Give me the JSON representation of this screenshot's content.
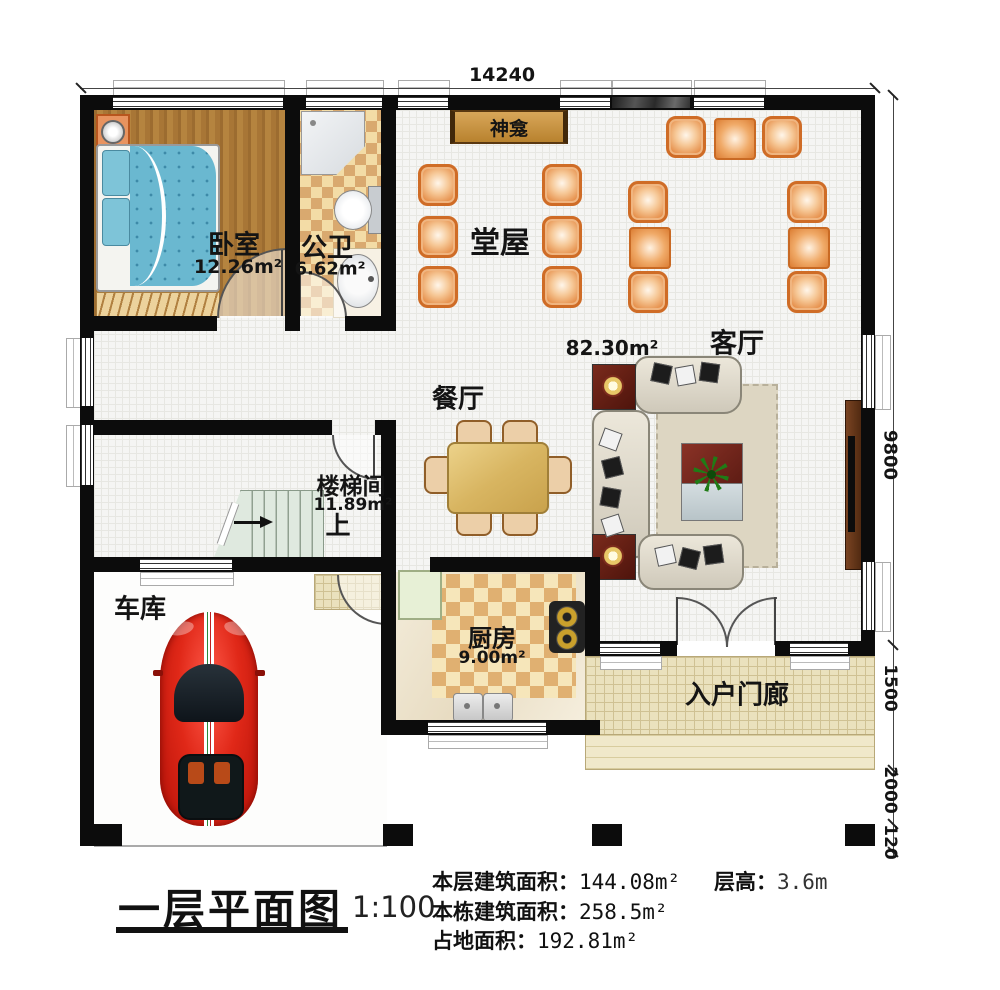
{
  "title": {
    "name": "一层平面图",
    "scale": "1:100"
  },
  "stats": {
    "floor_area_label": "本层建筑面积：",
    "floor_area_value": "144.08m²",
    "height_label": "层高：",
    "height_value": "3.6m",
    "building_area_label": "本栋建筑面积：",
    "building_area_value": "258.5m²",
    "footprint_label": "占地面积：",
    "footprint_value": "192.81m²"
  },
  "dimensions": {
    "width_top": "14240",
    "right_segments": [
      "9800",
      "1500",
      "2000",
      "120"
    ]
  },
  "rooms": {
    "bedroom": {
      "name": "卧室",
      "area": "12.26m²"
    },
    "bathroom": {
      "name": "公卫",
      "area": "6.62m²"
    },
    "hall": {
      "name": "堂屋"
    },
    "living": {
      "name": "客厅",
      "area": "82.30m²"
    },
    "dining": {
      "name": "餐厅"
    },
    "stairwell": {
      "name": "楼梯间",
      "area": "11.89m²",
      "direction": "上"
    },
    "garage": {
      "name": "车库"
    },
    "kitchen": {
      "name": "厨房",
      "area": "9.00m²"
    },
    "porch": {
      "name": "入户门廊"
    },
    "shrine": {
      "name": "神龛"
    }
  },
  "colors": {
    "wall": "#0c0c0c",
    "chair_accent": "#cf6c26",
    "car_red": "#c81a10",
    "bed_blue": "#6ab8d0"
  }
}
